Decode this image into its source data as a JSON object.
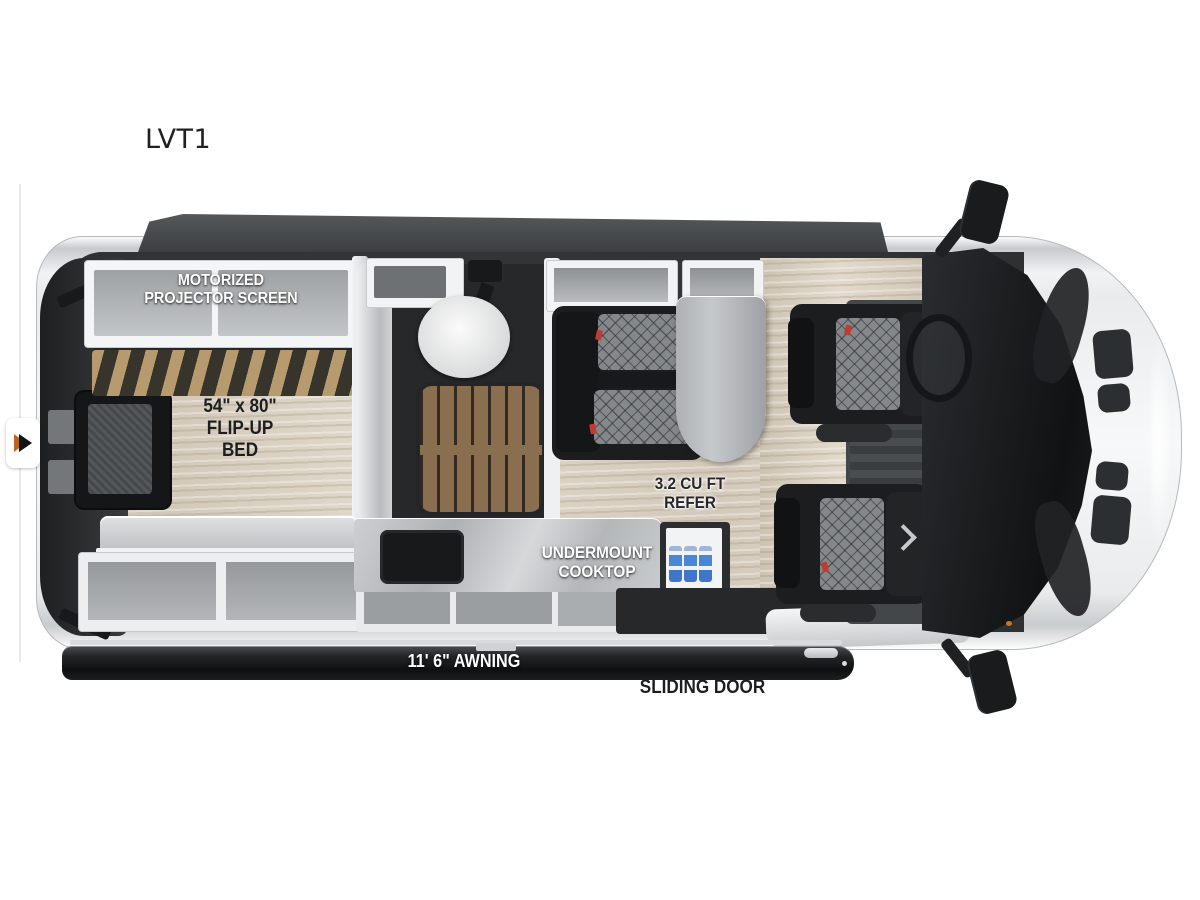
{
  "page": {
    "title": "LVT1"
  },
  "floorplan": {
    "model_label": "LVT1",
    "labels": {
      "projector_line1": "MOTORIZED",
      "projector_line2": "PROJECTOR SCREEN",
      "bed_line1": "54\" x 80\"",
      "bed_line2": "FLIP-UP",
      "bed_line3": "BED",
      "refer_line1": "3.2 CU FT",
      "refer_line2": "REFER",
      "cooktop_line1": "UNDERMOUNT",
      "cooktop_line2": "COOKTOP",
      "awning": "11' 6\" AWNING",
      "sliding_door": "SLIDING DOOR"
    },
    "icons": {
      "image_nav_arrow": "right-triangle"
    },
    "palette": {
      "background": "#ffffff",
      "body_silver": "#e8eaec",
      "interior_dark": "#303234",
      "wood_floor": "#d8d0c4",
      "bed_slats_tan": "#b79a6d",
      "shower_teak": "#8a6e50",
      "counter_marble": "#bfc2c4",
      "awning_black": "#151617",
      "bottle_blue": "#4a86d8",
      "arrow_orange": "#b9661e",
      "buckle_red": "#c03b30"
    }
  }
}
